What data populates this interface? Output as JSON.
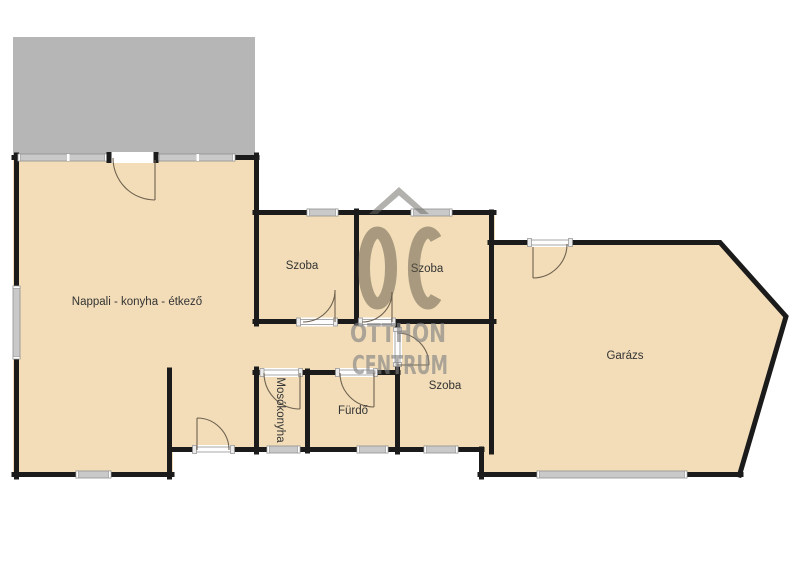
{
  "floorplan": {
    "type": "residential-floor-plan",
    "rooms": [
      {
        "id": "nappali-konyha-etkezo",
        "label": "Nappali - konyha - étkező"
      },
      {
        "id": "szoba-1",
        "label": "Szoba"
      },
      {
        "id": "szoba-2",
        "label": "Szoba"
      },
      {
        "id": "szoba-3",
        "label": "Szoba"
      },
      {
        "id": "mosokonyha",
        "label": "Mosókonyha"
      },
      {
        "id": "furdo",
        "label": "Fürdő"
      },
      {
        "id": "garazs",
        "label": "Garázs"
      }
    ],
    "watermark": {
      "monogram": "OC",
      "line1": "OTTHON",
      "line2": "CENTRUM"
    },
    "colors": {
      "background": "#ffffff",
      "floor": "#f2ddb8",
      "wall": "#1b1b1b",
      "terrace": "#b6b6b6",
      "window-fill": "#c9c9c9",
      "window-edge": "#8f8f8f",
      "door-line": "#6f6250",
      "label": "#333333",
      "wm-gray": "rgba(128,128,128,0.62)",
      "wm-tan": "rgba(95,88,70,0.5)",
      "wm-roof": "rgba(108,105,98,0.52)"
    }
  }
}
